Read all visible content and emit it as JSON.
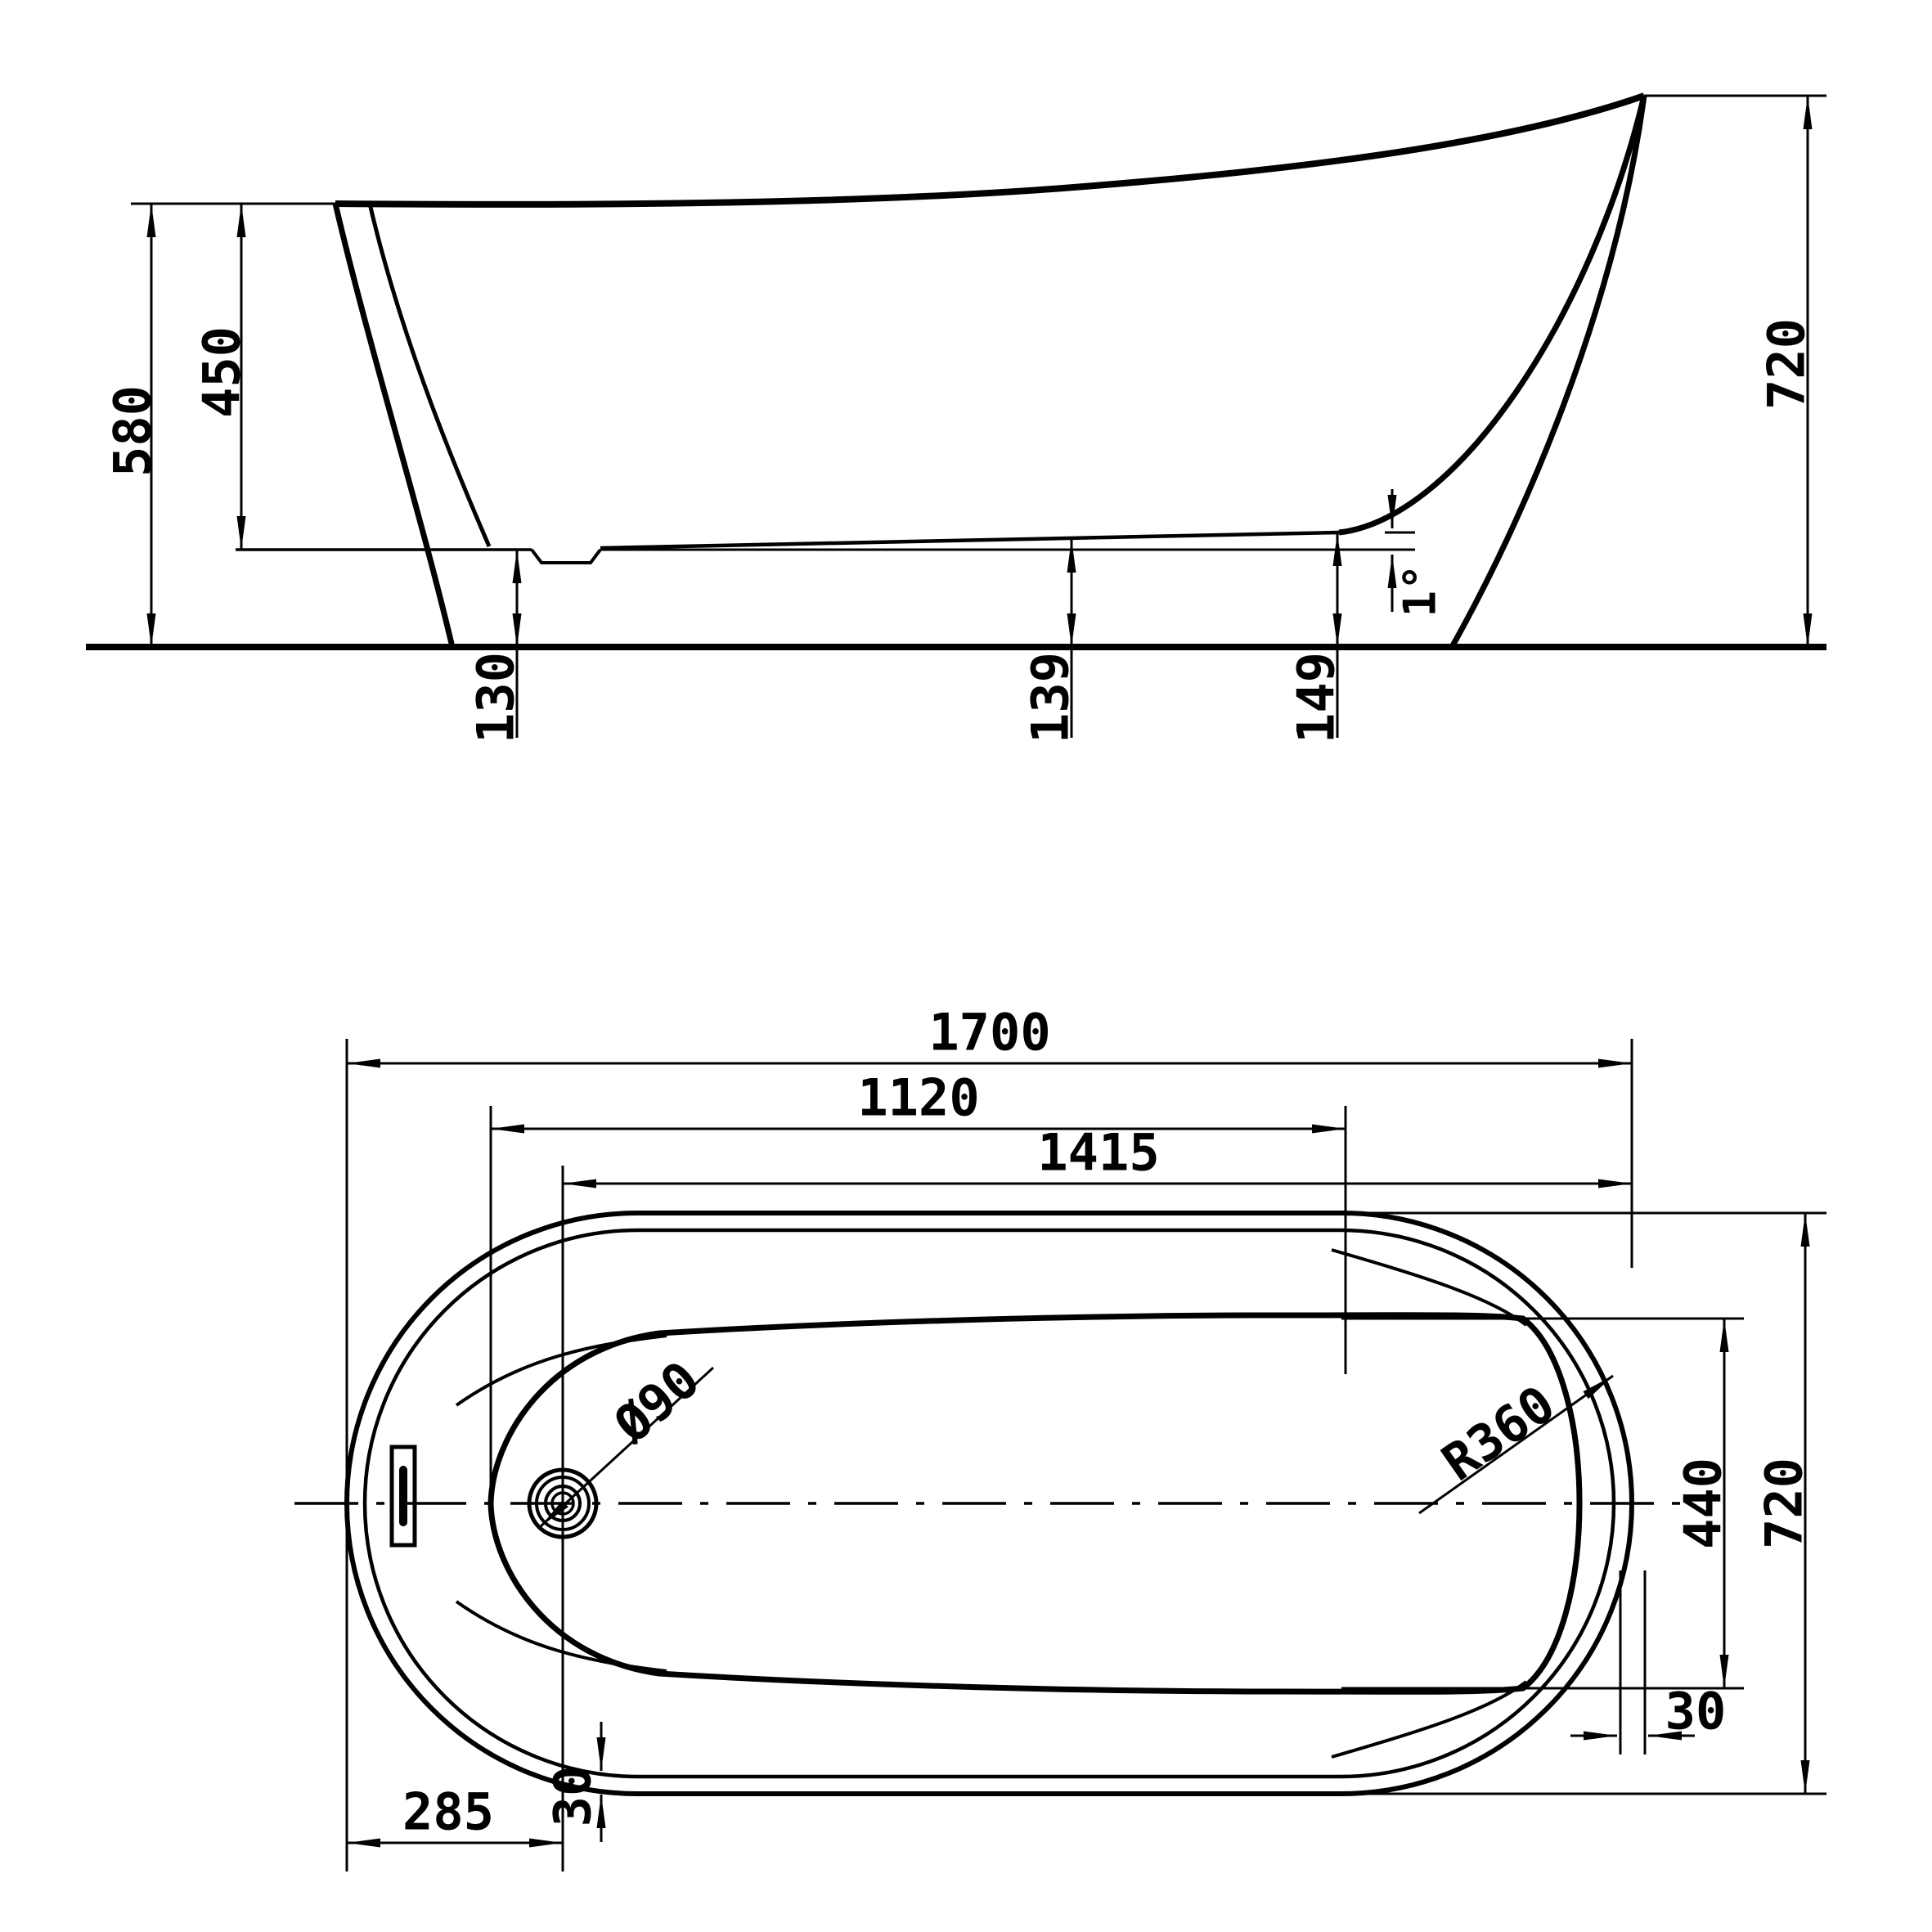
{
  "title": "freestanding-slipper-bathtub-technical-drawing",
  "colors": {
    "ink": "#000000",
    "background": "#ffffff"
  },
  "side_view": {
    "labels": {
      "height_overall": "580",
      "depth_interior": "450",
      "height_back": "720",
      "floor_height_front": "130",
      "floor_height_mid": "139",
      "floor_height_back": "149",
      "floor_slope_angle": "1°"
    }
  },
  "plan_view": {
    "labels": {
      "length_overall": "1700",
      "length_interior": "1120",
      "length_drain_to_back": "1415",
      "drain_diameter": "Ø90",
      "back_corner_radius": "R360",
      "width_interior": "440",
      "width_overall": "720",
      "wall_gap_right": "30",
      "wall_gap_bottom": "30",
      "drain_offset_from_end": "285"
    }
  }
}
